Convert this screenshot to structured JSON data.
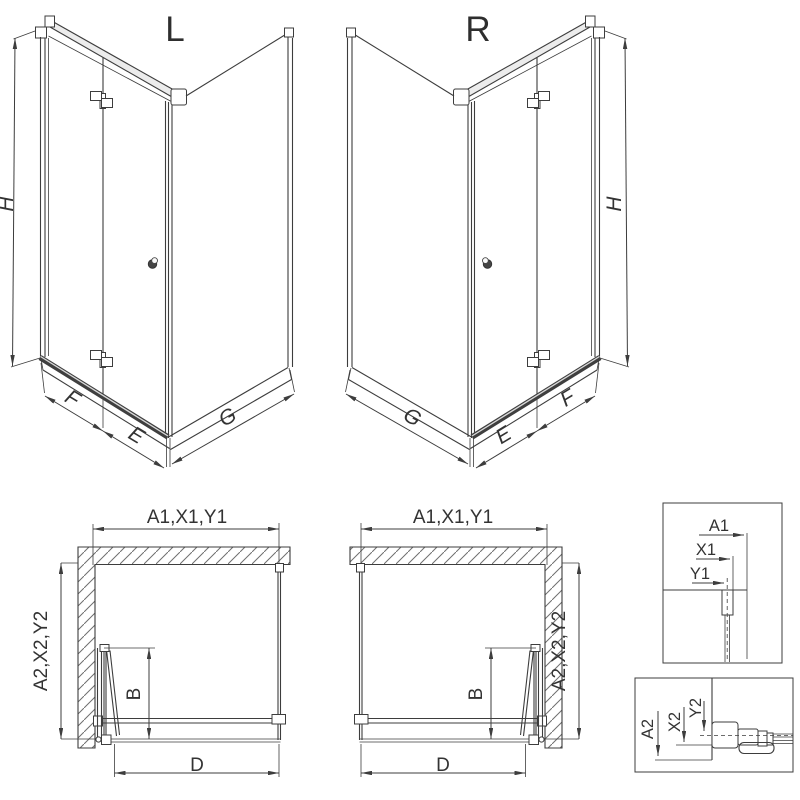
{
  "drawing": {
    "background": "#ffffff",
    "line_color": "#3d3d3d",
    "iso_left": {
      "label": "L",
      "dim_height": "H",
      "dim_front_panel": "F",
      "dim_front_door": "E",
      "dim_side_panel": "G"
    },
    "iso_right": {
      "label": "R",
      "dim_height": "H",
      "dim_front_panel": "F",
      "dim_front_door": "E",
      "dim_side_panel": "G"
    },
    "plan_left": {
      "dim_width": "A1,X1,Y1",
      "dim_depth": "A2,X2,Y2",
      "dim_door_projection": "B",
      "dim_entry": "D"
    },
    "plan_right": {
      "dim_width": "A1,X1,Y1",
      "dim_depth": "A2,X2,Y2",
      "dim_door_projection": "B",
      "dim_entry": "D"
    },
    "detail_width": {
      "dim_outer": "A1",
      "dim_mid": "X1",
      "dim_inner": "Y1"
    },
    "detail_depth": {
      "dim_outer": "A2",
      "dim_mid": "X2",
      "dim_inner": "Y2"
    }
  }
}
